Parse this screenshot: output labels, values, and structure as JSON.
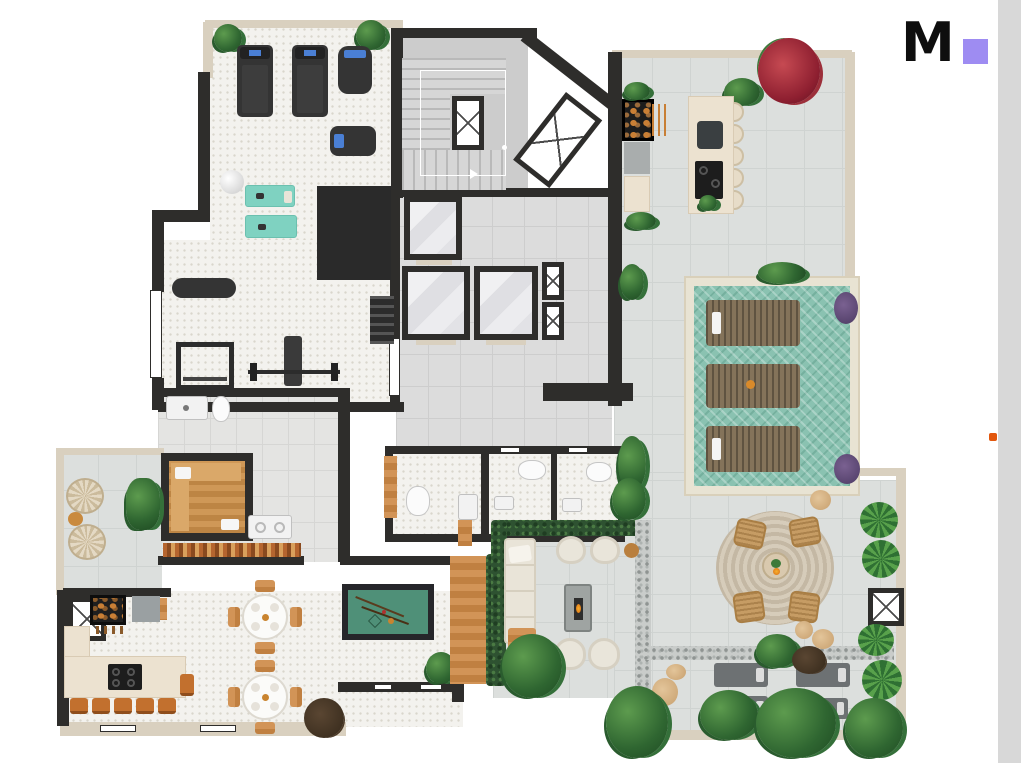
{
  "page": {
    "width": 1021,
    "height": 763,
    "background": "#ffffff"
  },
  "brand": {
    "logo_letter": "M",
    "logo_color": "#0e0e0e",
    "logo_square_color": "#9e8cf2"
  },
  "right_strip": {
    "color": "#d8d8d8"
  },
  "accent_dot": {
    "color": "#e2570d"
  },
  "plan_palette": {
    "wall": "#2e2d2b",
    "outer_wall": "#d9d0bf",
    "gym_floor": "#f3f2ee",
    "terrace_tile": "#dcdfdd",
    "indoor_tile": "#dcdcdc",
    "pool_water": "#8ac2b1",
    "pool_deck": "#e8e3d3",
    "yoga_mat": "#7fd2c1",
    "sauna_wood": "#c98f52",
    "deck_wood": "#cd9355",
    "counter": "#ece2d0",
    "stool_wood": "#c2702e",
    "billiard_felt": "#4f9078",
    "hedge": "#2e5231",
    "rug": "#cfc4b2",
    "sun_lounger_gray": "#6d7173",
    "elevator_marble": "#ebebed"
  }
}
